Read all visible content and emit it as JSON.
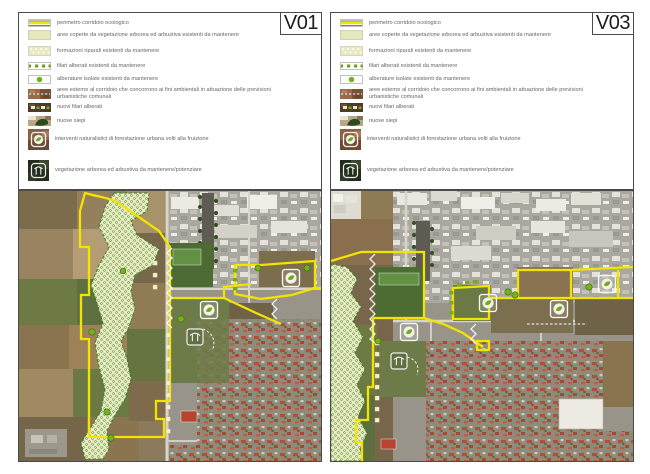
{
  "document": {
    "kind": "ecological-corridor-plan-comparison",
    "language": "it"
  },
  "panels": [
    {
      "id": "panel-v01",
      "title": "V01"
    },
    {
      "id": "panel-v03",
      "title": "V03"
    }
  ],
  "legend": [
    {
      "key": "perimetro-corridoio",
      "label": "perimetro corridoio ecologico",
      "swatch": "yellow-line",
      "color": "#f2e400"
    },
    {
      "key": "aree-coperte-vegetazione",
      "label": "aree coperte da vegetazione arborea ed arbustiva esistenti da mantenere",
      "swatch": "solid-khaki",
      "color": "#e7e7bd"
    },
    {
      "key": "formazioni-riparali",
      "label": "formazioni riparali esistenti da mantenere",
      "swatch": "dot-hatch",
      "color": "#e6ecc0"
    },
    {
      "key": "filari-alberati",
      "label": "filari alberati esistenti da mantenere",
      "swatch": "green-dash-squares",
      "color": "#7aa81e"
    },
    {
      "key": "alberature-isolate",
      "label": "alberature isolate esistenti da mantenere",
      "swatch": "green-dot",
      "color": "#72b21c"
    },
    {
      "key": "aree-esterne",
      "label": "aree esterne al corridoio che concorrono ai fini ambientali in attuazione delle previsioni urbanistiche comunali",
      "swatch": "photo-white-dashes"
    },
    {
      "key": "nuovi-filari",
      "label": "nuovi filari alberati",
      "swatch": "photo-cream-squares"
    },
    {
      "key": "nuove-siepi",
      "label": "nuove siepi",
      "swatch": "photo-hedge-blob"
    },
    {
      "key": "interventi-forestazione",
      "label": "interventi naturalistici di forestazione urbana volti alla fruizione",
      "swatch": "circle-tree-icon"
    },
    {
      "key": "vegetazione-potenziare",
      "label": "vegetazione arborea ed arbustiva da mantenere/potenziare",
      "swatch": "square-tree-icon"
    }
  ],
  "map": {
    "type": "aerial-orthophoto",
    "overlays": [
      "corridor-perimeter-yellow",
      "riparian-hatch-area",
      "new-hedge-white-zigzag",
      "new-tree-rows-cream-squares",
      "existing-tree-rows-green-squares",
      "isolated-trees-green-dots",
      "urban-forestation-circle-icons",
      "vegetation-maintain-square-icon",
      "white-dashed-limits"
    ]
  },
  "colors": {
    "corridor_yellow": "#f2e300",
    "riparian_fill": "#e6ecc0",
    "riparian_edge": "#3a7a2a",
    "isolated_tree_green": "#72b21c",
    "hedge_white": "#ffffff",
    "new_rows_cream": "#f4efc6"
  }
}
